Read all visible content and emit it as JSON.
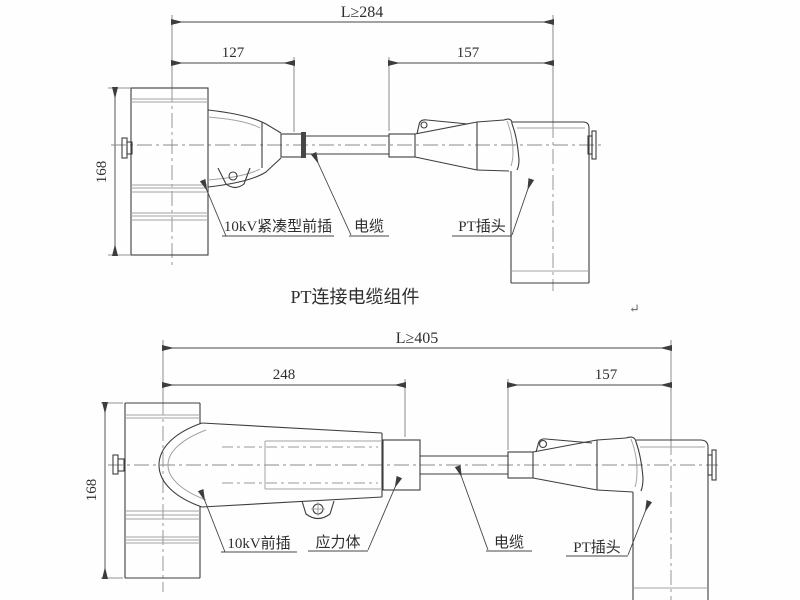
{
  "drawing": {
    "type": "engineering-cad-diagram",
    "colors": {
      "background": "#fefefe",
      "outline": "#3d3d3d",
      "light_line": "#a2a2a2",
      "centerline": "#8a8a8a",
      "dimension": "#454545"
    },
    "top": {
      "title": "PT连接电缆组件",
      "dim_overall": "L≥284",
      "dim_left": "127",
      "dim_right": "157",
      "dim_height": "168",
      "label_plug": "10kV紧凑型前插",
      "label_cable": "电缆",
      "label_pt": "PT插头"
    },
    "bottom": {
      "dim_overall": "L≥405",
      "dim_left": "248",
      "dim_right": "157",
      "dim_height": "168",
      "label_plug": "10kV前插",
      "label_stress": "应力体",
      "label_cable": "电缆",
      "label_pt": "PT插头"
    },
    "marks": {
      "return_mark": "↵"
    }
  }
}
